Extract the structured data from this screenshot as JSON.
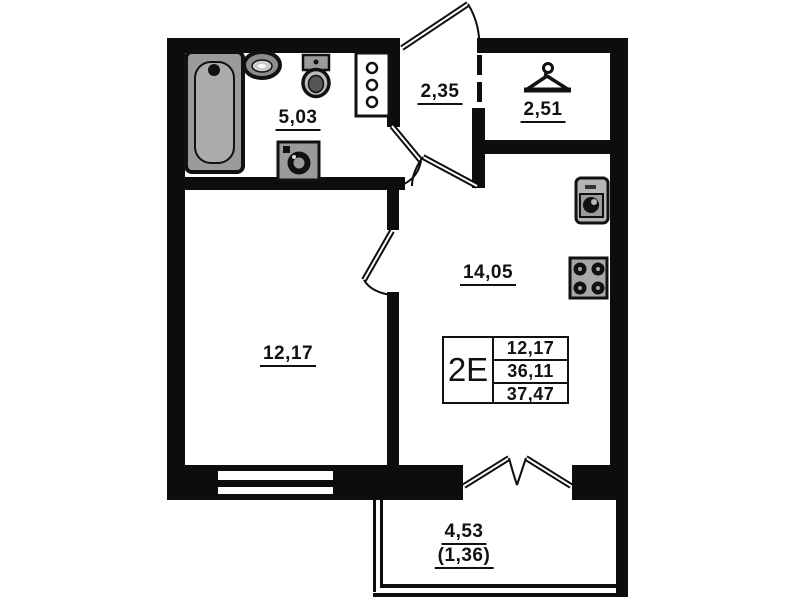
{
  "floor_plan": {
    "unit_card": {
      "type": "2E",
      "rows": [
        "12,17",
        "36,11",
        "37,47"
      ]
    },
    "rooms": {
      "bathroom": {
        "area": "5,03"
      },
      "hallway": {
        "area": "2,35"
      },
      "wardrobe": {
        "area": "2,51"
      },
      "kitchen_living": {
        "area": "14,05"
      },
      "bedroom": {
        "area": "12,17"
      },
      "balcony": {
        "area": "4,53",
        "coefficient_area": "(1,36)"
      }
    },
    "icons": {
      "bathroom": [
        "bathtub-icon",
        "sink-icon",
        "toilet-icon",
        "washing-machine-icon",
        "ventilation-shaft-icon"
      ],
      "wardrobe": [
        "hanger-icon"
      ],
      "kitchen": [
        "kitchen-sink-icon",
        "stove-icon"
      ]
    },
    "colors": {
      "wall": "#0d0d0d",
      "fixture_gray": "#9b9b9b",
      "background": "#ffffff"
    }
  }
}
